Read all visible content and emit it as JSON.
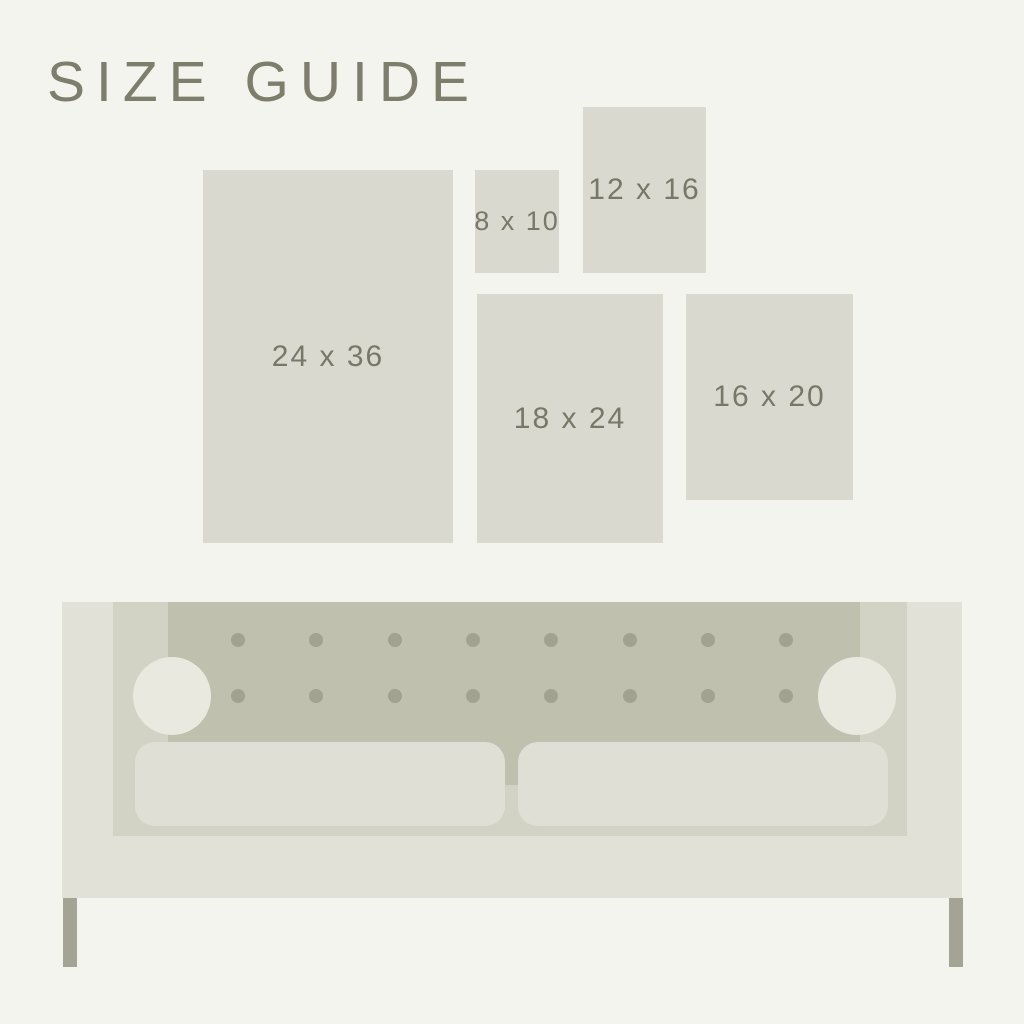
{
  "title": "SIZE GUIDE",
  "sizes": [
    {
      "label": "24 x 36",
      "width_in": 24,
      "height_in": 36
    },
    {
      "label": "8 x 10",
      "width_in": 8,
      "height_in": 10
    },
    {
      "label": "12 x 16",
      "width_in": 12,
      "height_in": 16
    },
    {
      "label": "18 x 24",
      "width_in": 18,
      "height_in": 24
    },
    {
      "label": "16 x 20",
      "width_in": 16,
      "height_in": 20
    }
  ],
  "couch": {
    "tufting": {
      "rows": 2,
      "cols": 8
    }
  },
  "colors": {
    "background": "#f4f4ef",
    "swatch": "#d9d9d0",
    "title_text": "#7e7e6c",
    "label_text": "#787868",
    "couch_body": "#e1e1d8",
    "couch_inner": "#d3d3c5",
    "couch_tufted_back": "#bfc0ae",
    "tuft_button": "#a2a290",
    "armrest_knob": "#e9e9e0",
    "cushion": "#dfdfd5",
    "leg": "#a4a494"
  }
}
